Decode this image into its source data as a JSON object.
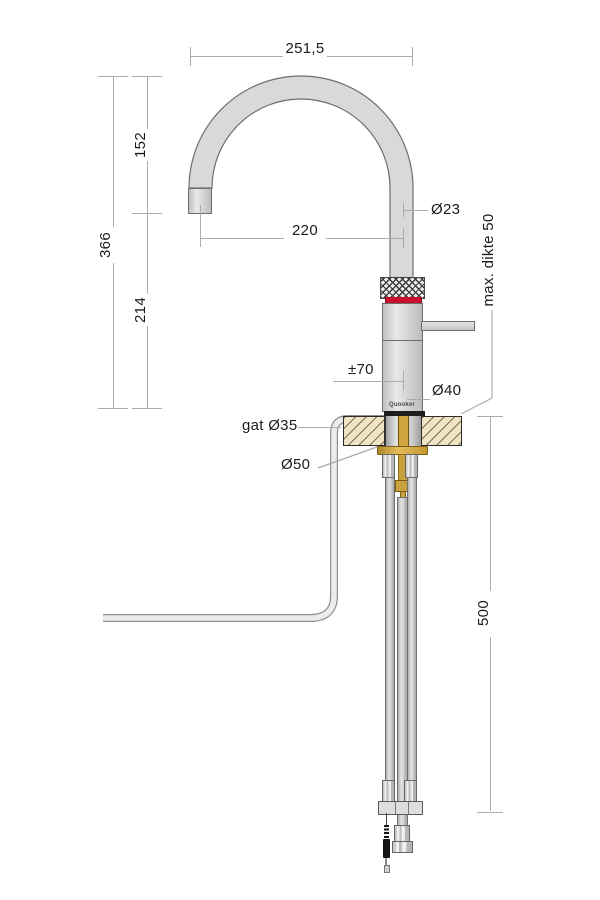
{
  "drawing": {
    "title": "Quooker faucet installation dimension drawing",
    "brand_logo": "Quooker",
    "dimensions": {
      "top_width": "251,5",
      "height_total": "366",
      "height_upper": "152",
      "height_lower": "214",
      "reach": "220",
      "spout_diameter": "Ø23",
      "max_counter_thickness": "max. dikte 50",
      "handle_clearance": "±70",
      "body_diameter": "Ø40",
      "hole_diameter": "gat Ø35",
      "flange_diameter": "Ø50",
      "under_counter_depth": "500"
    },
    "colors": {
      "accent_red": "#c8102e",
      "brass": "#c9a23e",
      "counter_beige": "#efe5c6",
      "metal_gray": "#d9d9d9",
      "dimension_line": "#ababab",
      "outline": "#6e6e6e"
    }
  }
}
